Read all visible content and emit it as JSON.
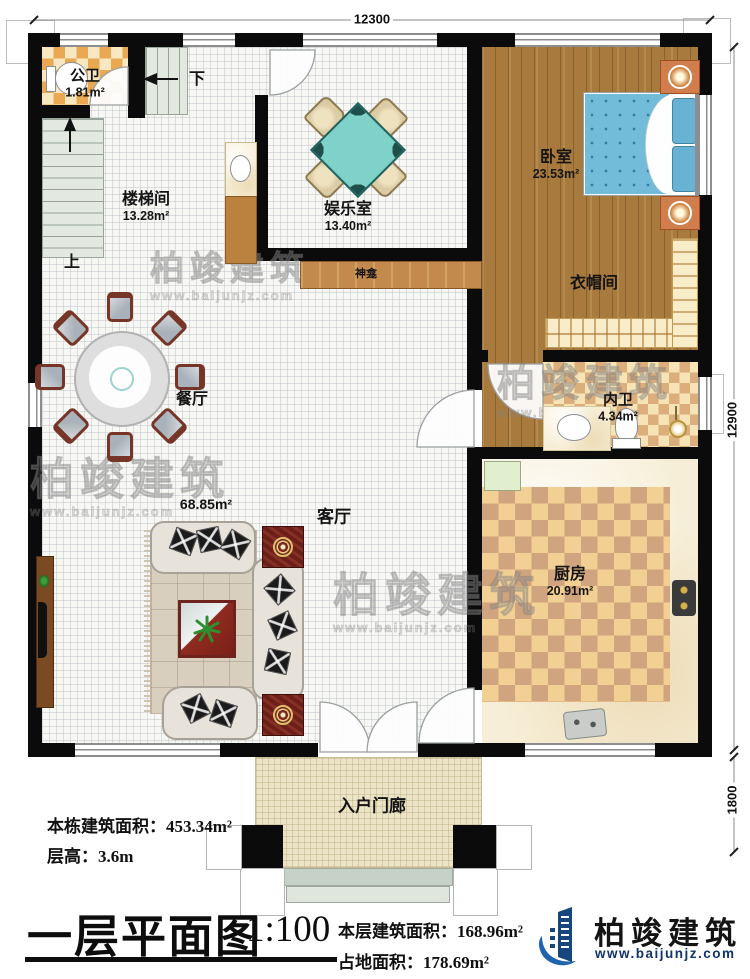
{
  "rooms": [
    {
      "name": "公卫",
      "area": "1.81m²"
    },
    {
      "name": "楼梯间",
      "area": "13.28m²"
    },
    {
      "name": "娱乐室",
      "area": "13.40m²"
    },
    {
      "name": "卧室",
      "area": "23.53m²"
    },
    {
      "name": "衣帽间",
      "area": ""
    },
    {
      "name": "内卫",
      "area": "4.34m²"
    },
    {
      "name": "餐厅",
      "area": ""
    },
    {
      "name": "客厅",
      "area": "68.85m²"
    },
    {
      "name": "厨房",
      "area": "20.91m²"
    },
    {
      "name": "入户门廊",
      "area": ""
    },
    {
      "name": "神龛",
      "area": ""
    }
  ],
  "stairs": {
    "up": "上",
    "down": "下"
  },
  "dimensions": {
    "top": "12300",
    "right_main": "12900",
    "right_porch": "1800"
  },
  "stats": {
    "building_area": "本栋建筑面积：453.34m²",
    "floor_height": "层高：3.6m"
  },
  "title_block": {
    "title": "一层平面图",
    "scale": "1:100",
    "floor_area": "本层建筑面积：168.96m²",
    "site_area": "占地面积：178.69m²"
  },
  "brand": {
    "name": "柏竣建筑",
    "site": "www.baijunjz.com"
  }
}
